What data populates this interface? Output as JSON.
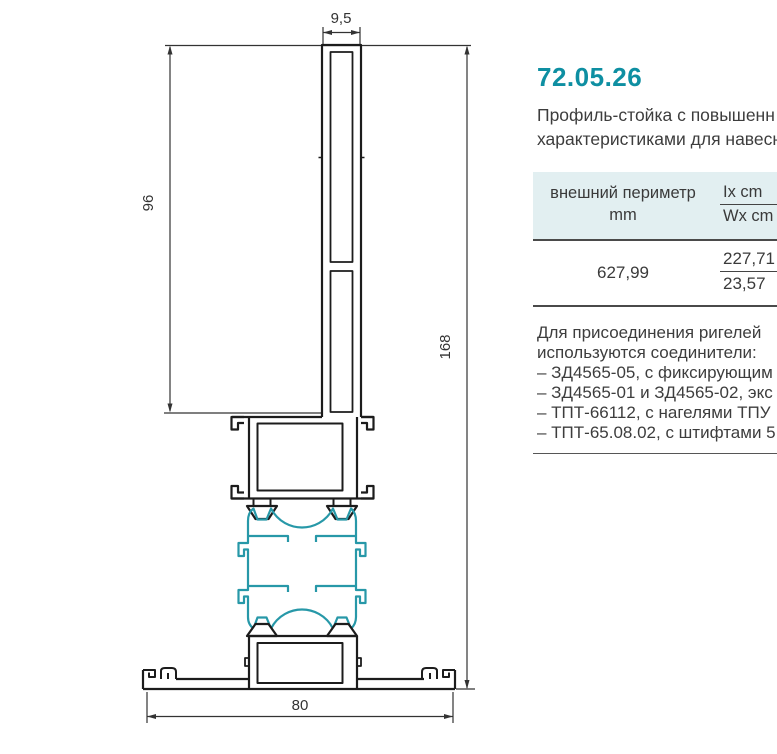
{
  "product": {
    "code": "72.05.26",
    "description_line1": "Профиль-стойка с повышенн",
    "description_line2": "характеристиками для навесн"
  },
  "table": {
    "header": {
      "col1_line1": "внешний периметр",
      "col1_line2": "mm",
      "ix_label": "Ix cm",
      "wx_label": "Wx cm"
    },
    "row": {
      "perimeter": "627,99",
      "ix_value": "227,71",
      "wx_value": "23,57"
    }
  },
  "notes": {
    "intro_line1": "Для присоединения ригелей",
    "intro_line2": "используются соединители:",
    "items": [
      "– ЗД4565-05, с фиксирующим",
      "– ЗД4565-01 и ЗД4565-02, экс",
      "– ТПТ-66112, с нагелями ТПУ",
      "– ТПТ-65.08.02, с штифтами 5"
    ]
  },
  "drawing": {
    "dim_top_mm": "9,5",
    "dim_left_mm": "96",
    "dim_right_mm": "168",
    "dim_bottom_mm": "80"
  },
  "colors": {
    "accent_teal": "#0e8fa2",
    "insulator_teal": "#2798a8",
    "line_black": "#1c1c1c",
    "table_header_bg": "#e2eff1",
    "text_gray": "#3d3d3d"
  }
}
